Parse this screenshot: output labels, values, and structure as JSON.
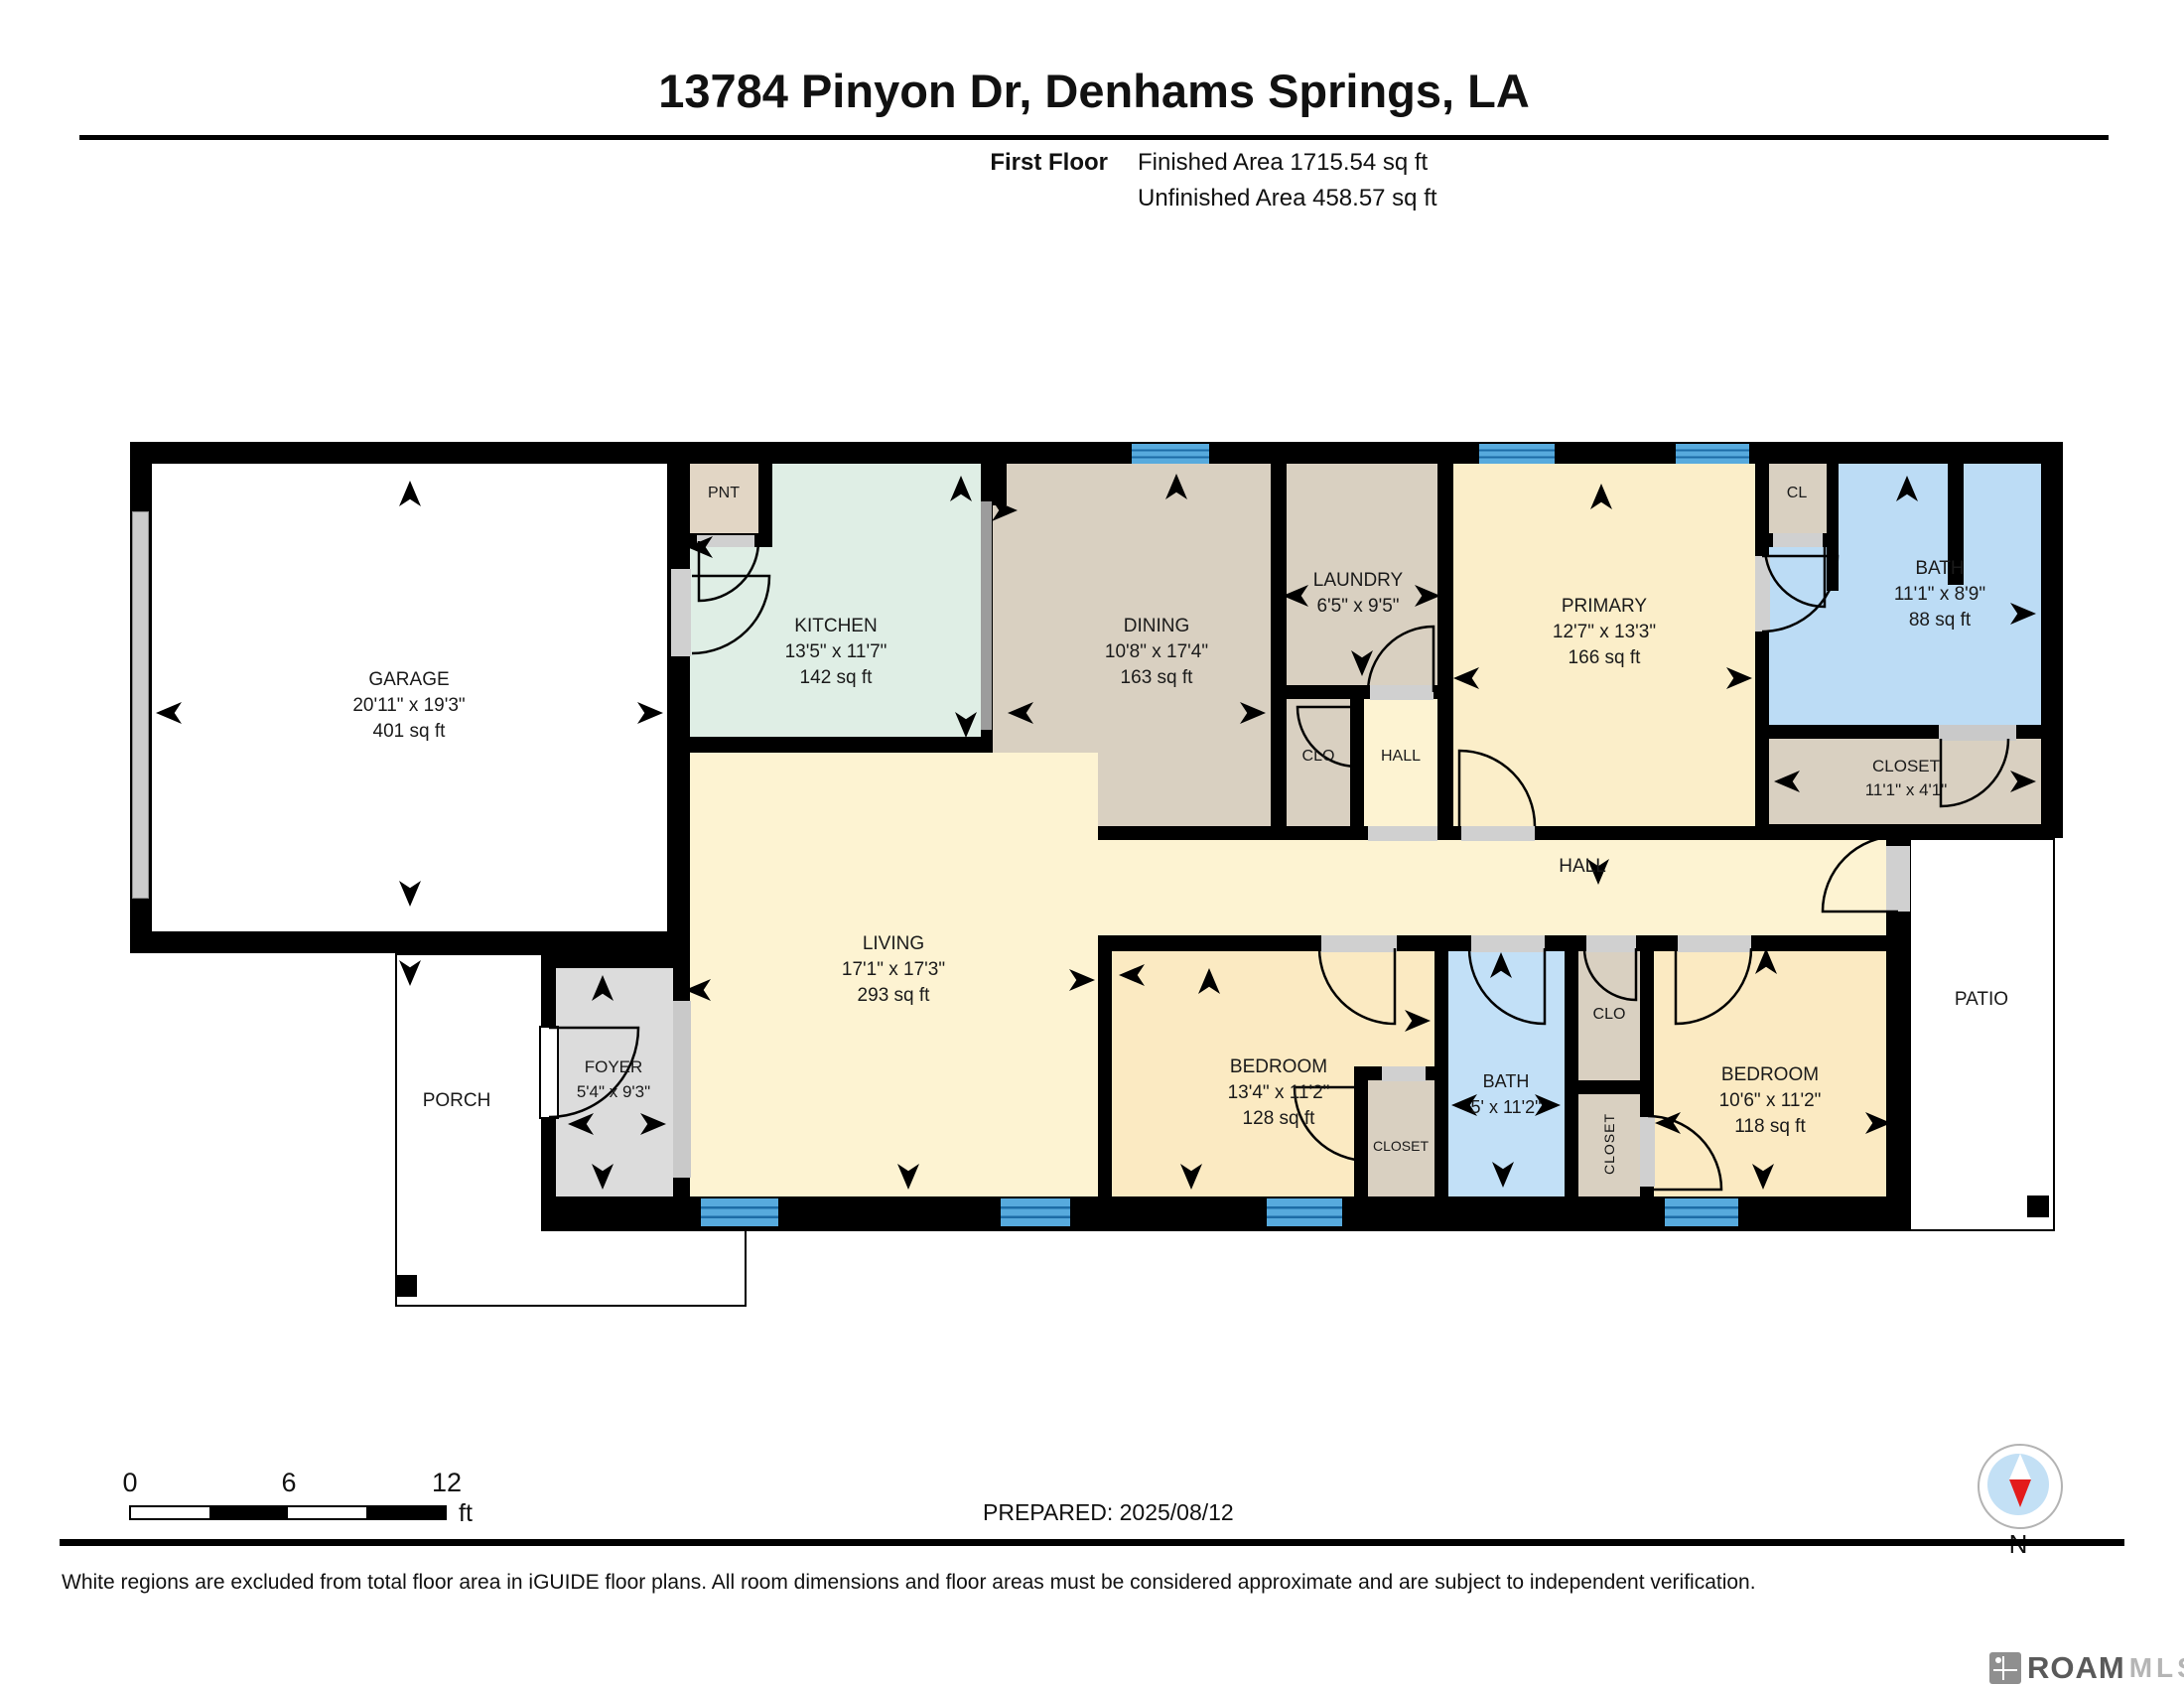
{
  "title": "13784 Pinyon Dr, Denhams Springs, LA",
  "floor_info": {
    "label": "First Floor",
    "finished": "Finished Area 1715.54 sq ft",
    "unfinished": "Unfinished Area 458.57 sq ft"
  },
  "rooms": {
    "garage": {
      "name": "GARAGE",
      "dims": "20'11\" x 19'3\"",
      "area": "401 sq ft"
    },
    "kitchen": {
      "name": "KITCHEN",
      "dims": "13'5\" x 11'7\"",
      "area": "142 sq ft"
    },
    "pnt": {
      "name": "PNT"
    },
    "dining": {
      "name": "DINING",
      "dims": "10'8\" x 17'4\"",
      "area": "163 sq ft"
    },
    "laundry": {
      "name": "LAUNDRY",
      "dims": "6'5\" x 9'5\""
    },
    "clo_top": {
      "name": "CLO"
    },
    "hall_top": {
      "name": "HALL"
    },
    "primary": {
      "name": "PRIMARY",
      "dims": "12'7\" x 13'3\"",
      "area": "166 sq ft"
    },
    "cl": {
      "name": "CL"
    },
    "bath_primary": {
      "name": "BATH",
      "dims": "11'1\" x 8'9\"",
      "area": "88 sq ft"
    },
    "closet_primary": {
      "name": "CLOSET",
      "dims": "11'1\" x 4'1\""
    },
    "hall": {
      "name": "HALL"
    },
    "living": {
      "name": "LIVING",
      "dims": "17'1\" x 17'3\"",
      "area": "293 sq ft"
    },
    "foyer": {
      "name": "FOYER",
      "dims": "5'4\" x 9'3\""
    },
    "porch": {
      "name": "PORCH"
    },
    "bedroom_left": {
      "name": "BEDROOM",
      "dims": "13'4\" x 11'2\"",
      "area": "128 sq ft"
    },
    "closet_bedroom_left": {
      "name": "CLOSET"
    },
    "bath_hall": {
      "name": "BATH",
      "dims": "5' x 11'2\""
    },
    "clo_bottom": {
      "name": "CLO"
    },
    "closet_bottom": {
      "name": "CLOSET"
    },
    "bedroom_right": {
      "name": "BEDROOM",
      "dims": "10'6\" x 11'2\"",
      "area": "118 sq ft"
    },
    "patio": {
      "name": "PATIO"
    }
  },
  "scale_bar": {
    "start": "0",
    "mid": "6",
    "end": "12",
    "unit": "ft"
  },
  "prepared": "PREPARED: 2025/08/12",
  "compass_label": "N",
  "footer_note": "White regions are excluded from total floor area in iGUIDE floor plans. All room dimensions and floor areas must be considered approximate and are subject to independent verification.",
  "logo": {
    "name": "ROAM",
    "suffix": "MLS"
  },
  "colors": {
    "wall": "#000000",
    "tan": "#d9d0c1",
    "mint": "#dfeee5",
    "pale_yellow": "#fdf3d2",
    "bedroom_yellow": "#fbeac2",
    "bath_blue": "#bcdcf5",
    "window_blue": "#57aadd",
    "foyer_gray": "#dcdcdc"
  }
}
